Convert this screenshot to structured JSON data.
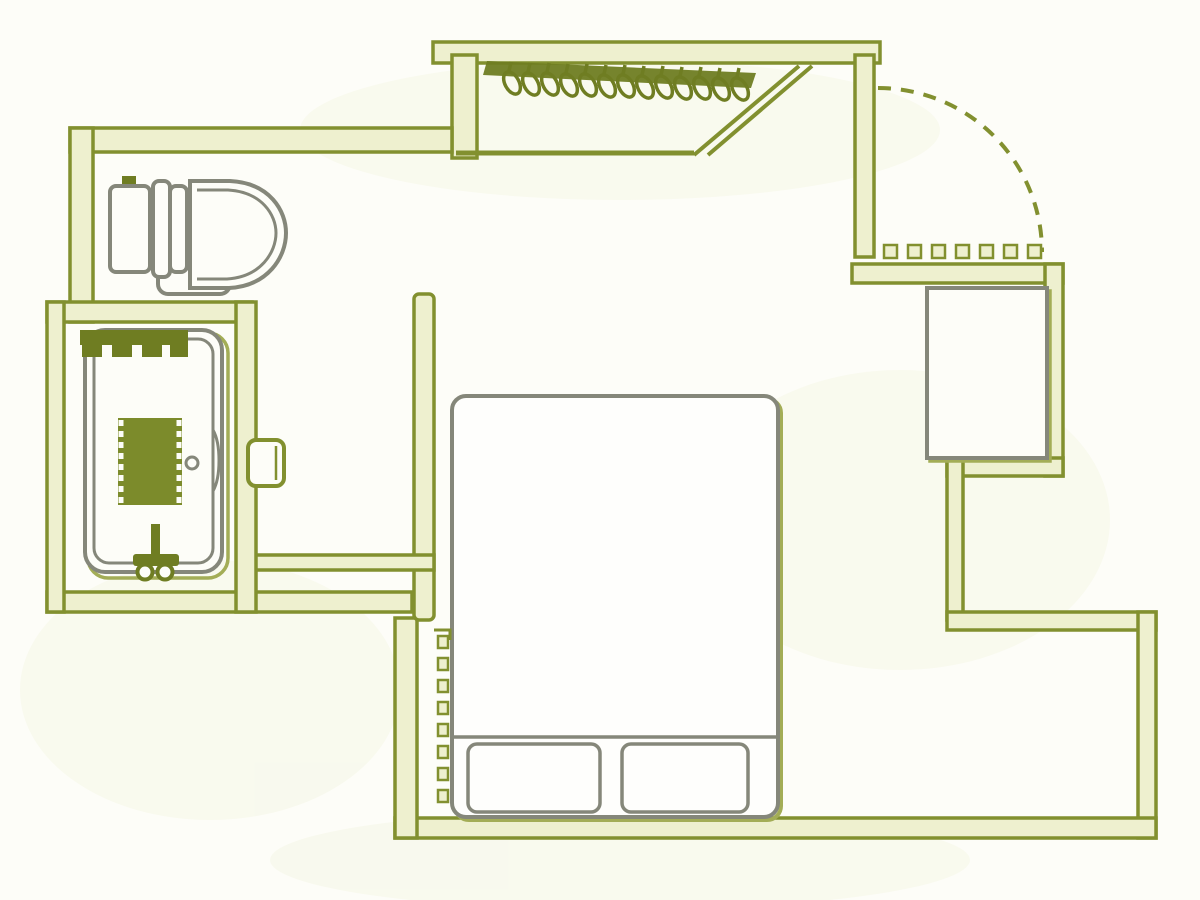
{
  "figure": {
    "kind": "floor-plan",
    "description": "line-drawn room floor plan, olive-green ink on white"
  },
  "colors": {
    "background": "#fdfdf8",
    "wall_stroke": "#82902f",
    "wall_fill": "#eef0cf",
    "fixture_stroke": "#85877a",
    "dark_olive": "#6f7d22",
    "shadow_olive": "#a3ad56",
    "grate_olive": "#7c8b2b"
  },
  "plan": {
    "rooms": [
      "closet",
      "entry-hall",
      "toilet-area",
      "bathtub-room",
      "bedroom"
    ],
    "fixtures": [
      "clothes-hangers",
      "closet-door-diagonal",
      "entry-door-swing-arc",
      "entry-door-threshold",
      "toilet",
      "bathtub",
      "bathtub-grate",
      "bathtub-faucet",
      "bathtub-drain",
      "bath-door-handle",
      "storage-cabinet",
      "double-bed",
      "pillows",
      "step-dashed-line"
    ],
    "counts": {
      "hangers": 13,
      "threshold_dashes": 7,
      "step_dashes": 8,
      "pillows": 2
    }
  }
}
